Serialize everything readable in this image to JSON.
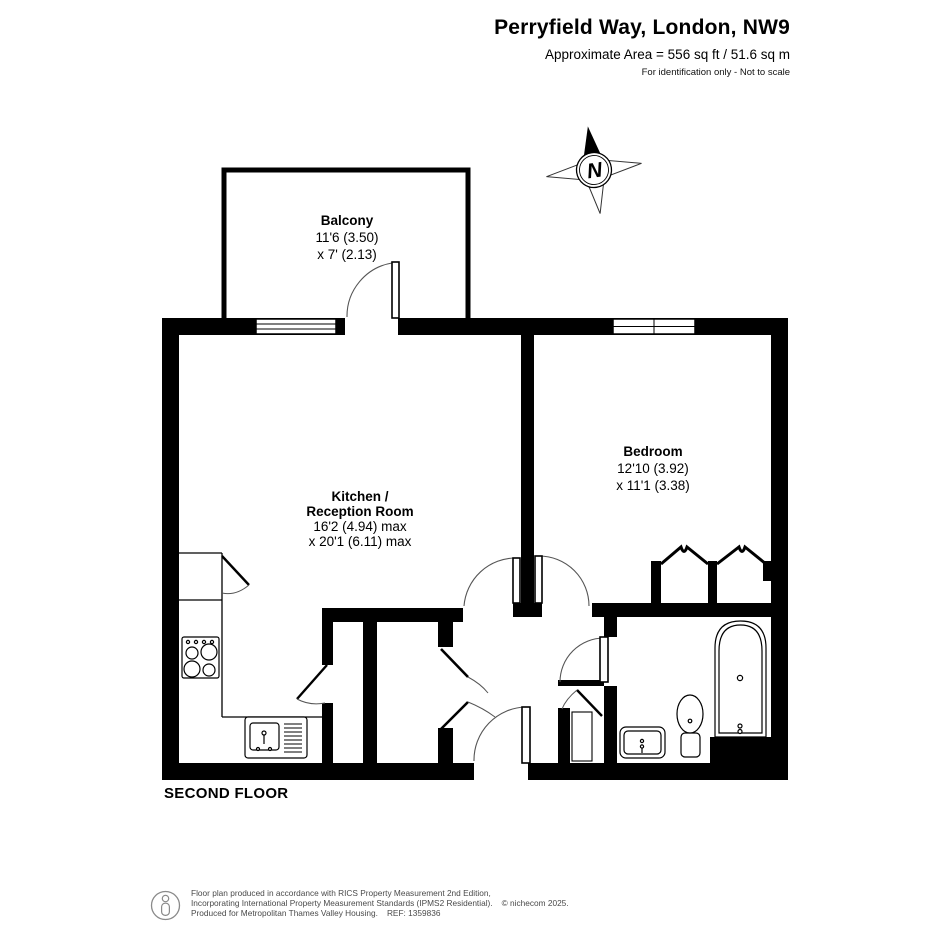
{
  "header": {
    "title": "Perryfield Way, London, NW9",
    "area_line": "Approximate Area = 556 sq ft / 51.6 sq m",
    "disclaimer": "For identification only - Not to scale"
  },
  "compass": {
    "label": "N"
  },
  "rooms": {
    "balcony": {
      "name": "Balcony",
      "dim1": "11'6 (3.50)",
      "dim2": "x 7' (2.13)"
    },
    "kitchen": {
      "name_line1": "Kitchen /",
      "name_line2": "Reception Room",
      "dim1": "16'2 (4.94) max",
      "dim2": "x 20'1 (6.11) max"
    },
    "bedroom": {
      "name": "Bedroom",
      "dim1": "12'10 (3.92)",
      "dim2": "x 11'1 (3.38)"
    }
  },
  "floor_label": "SECOND FLOOR",
  "footer": {
    "line1": "Floor plan produced in accordance with RICS Property Measurement 2nd Edition,",
    "line2": "Incorporating International Property Measurement Standards (IPMS2 Residential).",
    "copyright": "© nichecom 2025.",
    "line3": "Produced for Metropolitan Thames Valley Housing.",
    "ref": "REF: 1359836"
  },
  "icons": {
    "compass": "north-star-compass",
    "footer_logo": "person-in-circle",
    "fixtures": [
      "stove",
      "kitchen-sink",
      "bathtub",
      "toilet",
      "basin"
    ]
  }
}
